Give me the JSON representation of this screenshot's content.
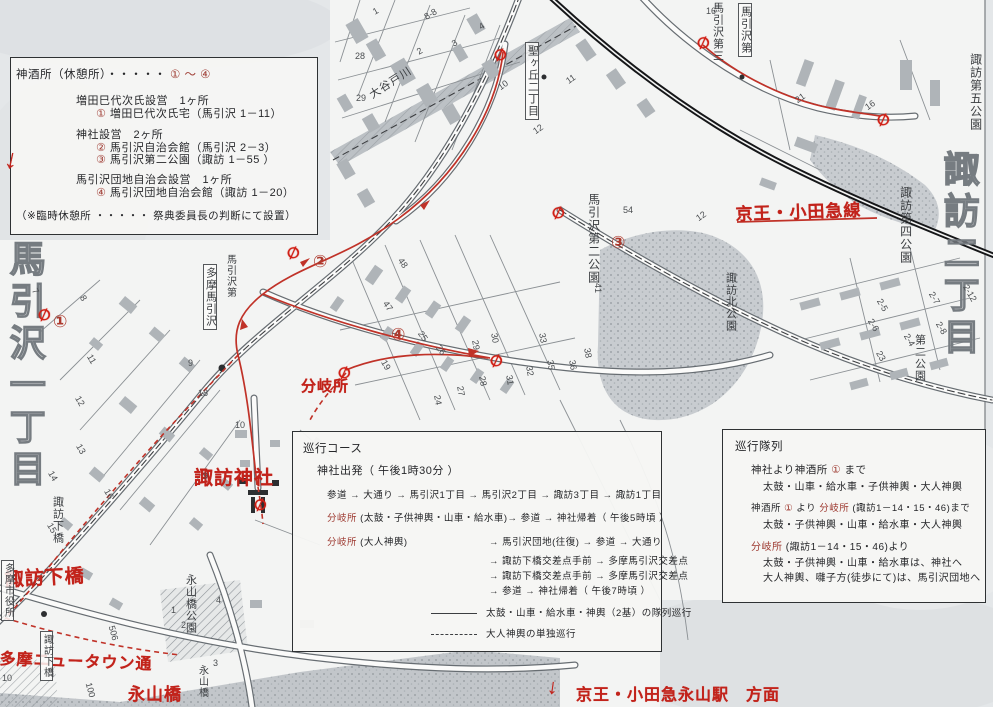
{
  "colors": {
    "paper": "#e6e8ea",
    "map_white": "#f3f4f3",
    "red_ink": "#c2231b",
    "box_red": "#9e3a31",
    "route_red": "#c03228",
    "railway_black": "#151618"
  },
  "boxes": {
    "rest": {
      "rows": [
        {
          "x": 5,
          "y": 8,
          "s": 11.5,
          "segs": [
            {
              "t": "神酒所（休憩所）・・・・・ "
            },
            {
              "t": "① ～ ④",
              "r": 1
            }
          ]
        },
        {
          "x": 65,
          "y": 34,
          "s": 11,
          "segs": [
            {
              "t": "増田巳代次氏設営　1ヶ所"
            }
          ]
        },
        {
          "x": 85,
          "y": 47,
          "s": 11,
          "segs": [
            {
              "t": "①",
              "r": 1
            },
            {
              "t": " 増田巳代次氏宅（馬引沢 1－11）"
            }
          ]
        },
        {
          "x": 65,
          "y": 68,
          "s": 11,
          "segs": [
            {
              "t": "神社設営　2ヶ所"
            }
          ]
        },
        {
          "x": 85,
          "y": 81,
          "s": 11,
          "segs": [
            {
              "t": "②",
              "r": 1
            },
            {
              "t": " 馬引沢自治会館（馬引沢 2－3）"
            }
          ]
        },
        {
          "x": 85,
          "y": 93,
          "s": 11,
          "segs": [
            {
              "t": "③",
              "r": 1
            },
            {
              "t": " 馬引沢第二公園（諏訪 1－55 ）"
            }
          ]
        },
        {
          "x": 65,
          "y": 113,
          "s": 11,
          "segs": [
            {
              "t": "馬引沢団地自治会設営　1ヶ所"
            }
          ]
        },
        {
          "x": 85,
          "y": 126,
          "s": 11,
          "segs": [
            {
              "t": "④",
              "r": 1
            },
            {
              "t": " 馬引沢団地自治会館（諏訪 1－20）"
            }
          ]
        },
        {
          "x": 5,
          "y": 150,
          "s": 10.5,
          "segs": [
            {
              "t": "（※臨時休憩所 ・・・・・ 祭典委員長の判断にて設置）"
            }
          ]
        }
      ]
    },
    "course": {
      "rows": [
        {
          "x": 10,
          "y": 8,
          "s": 11.5,
          "segs": [
            {
              "t": "巡行コース"
            }
          ]
        },
        {
          "x": 24,
          "y": 30,
          "s": 11,
          "segs": [
            {
              "t": "神社出発（ 午後1時30分 ）"
            }
          ]
        },
        {
          "x": 34,
          "y": 55,
          "s": 9.5,
          "segs": [
            {
              "t": "参道 → 大通り → 馬引沢1丁目 → 馬引沢2丁目 → 諏訪3丁目 → 諏訪1丁目"
            }
          ]
        },
        {
          "x": 34,
          "y": 78,
          "s": 9.5,
          "segs": [
            {
              "t": "分岐所",
              "r": 1
            },
            {
              "t": " (太鼓・子供神輿・山車・給水車)→ 参道 → 神社帰着（ 午後5時頃 ）"
            }
          ]
        },
        {
          "x": 34,
          "y": 102,
          "s": 9.5,
          "segs": [
            {
              "t": "分岐所",
              "r": 1
            },
            {
              "t": " (大人神輿)"
            }
          ]
        },
        {
          "x": 196,
          "y": 102,
          "s": 9.5,
          "segs": [
            {
              "t": "→ 馬引沢団地(往復) → 参道 → 大通り"
            }
          ]
        },
        {
          "x": 196,
          "y": 121,
          "s": 9.5,
          "segs": [
            {
              "t": "→ 諏訪下橋交差点手前 → 多摩馬引沢交差点"
            }
          ]
        },
        {
          "x": 196,
          "y": 136,
          "s": 9.5,
          "segs": [
            {
              "t": "→ 諏訪下橋交差点手前 → 多摩馬引沢交差点"
            }
          ]
        },
        {
          "x": 196,
          "y": 151,
          "s": 9.5,
          "segs": [
            {
              "t": "→ 参道 → 神社帰着（ 午後7時頃 ）"
            }
          ]
        },
        {
          "x": 138,
          "y": 173,
          "s": 9.5,
          "m": "solid",
          "segs": [
            {
              "t": "太鼓・山車・給水車・神輿（2基）の隊列巡行"
            }
          ]
        },
        {
          "x": 138,
          "y": 194,
          "s": 9.5,
          "m": "dashed",
          "segs": [
            {
              "t": "大人神輿の単独巡行"
            }
          ]
        }
      ]
    },
    "formation": {
      "rows": [
        {
          "x": 12,
          "y": 8,
          "s": 11.5,
          "segs": [
            {
              "t": "巡行隊列"
            }
          ]
        },
        {
          "x": 28,
          "y": 32,
          "s": 10.5,
          "segs": [
            {
              "t": "神社より神酒所 "
            },
            {
              "t": "①",
              "r": 1
            },
            {
              "t": " まで"
            }
          ]
        },
        {
          "x": 40,
          "y": 48,
          "s": 10,
          "segs": [
            {
              "t": "太鼓・山車・給水車・子供神輿・大人神輿"
            }
          ]
        },
        {
          "x": 28,
          "y": 70,
          "s": 9.5,
          "segs": [
            {
              "t": "神酒所 "
            },
            {
              "t": "①",
              "r": 1
            },
            {
              "t": " より "
            },
            {
              "t": "分岐所",
              "r": 1
            },
            {
              "t": " (諏訪1－14・15・46)まで"
            }
          ]
        },
        {
          "x": 40,
          "y": 86,
          "s": 10,
          "segs": [
            {
              "t": "太鼓・子供神輿・山車・給水車・大人神輿"
            }
          ]
        },
        {
          "x": 28,
          "y": 108,
          "s": 10,
          "segs": [
            {
              "t": "分岐所",
              "r": 1
            },
            {
              "t": " (諏訪1－14・15・46)より"
            }
          ]
        },
        {
          "x": 40,
          "y": 124,
          "s": 10,
          "segs": [
            {
              "t": "太鼓・子供神輿・山車・給水車は、神社へ"
            }
          ]
        },
        {
          "x": 40,
          "y": 139,
          "s": 10,
          "segs": [
            {
              "t": "大人神輿、囃子方(徒歩にて)は、馬引沢団地へ"
            }
          ]
        }
      ]
    }
  },
  "map": {
    "red_labels": [
      {
        "t": "京王・小田急線",
        "x": 735,
        "y": 200,
        "s": 17,
        "rot": -2
      },
      {
        "t": "分岐所",
        "x": 301,
        "y": 375,
        "s": 15,
        "rot": 0
      },
      {
        "t": "諏訪神社",
        "x": 194,
        "y": 463,
        "s": 19,
        "rot": 0
      },
      {
        "t": "諏訪下橋",
        "x": 4,
        "y": 565,
        "s": 19,
        "rot": -3
      },
      {
        "t": "多摩ニュータウン通",
        "x": 0,
        "y": 645,
        "s": 16,
        "rot": 2
      },
      {
        "t": "永山橋",
        "x": 128,
        "y": 680,
        "s": 17,
        "rot": 0
      },
      {
        "t": "↓",
        "x": 549,
        "y": 675,
        "s": 21,
        "rot": 8
      },
      {
        "t": "京王・小田急永山駅　方面",
        "x": 576,
        "y": 681,
        "s": 16,
        "rot": 0
      },
      {
        "t": "↓",
        "x": 8,
        "y": 143,
        "s": 27,
        "rot": 12
      }
    ],
    "black_labels": [
      {
        "t": "馬引沢一丁目",
        "x": 6,
        "y": 240,
        "s": 36,
        "outline": 1
      },
      {
        "t": "諏訪二丁目",
        "x": 940,
        "y": 150,
        "s": 36,
        "outline": 1
      },
      {
        "t": "諏訪第四公園",
        "x": 899,
        "y": 186,
        "s": 12
      },
      {
        "t": "諏訪第五公園",
        "x": 969,
        "y": 53,
        "s": 12
      },
      {
        "t": "第二公園",
        "x": 913,
        "y": 334,
        "s": 11
      },
      {
        "t": "諏訪北公園",
        "x": 724,
        "y": 272,
        "s": 11
      },
      {
        "t": "馬引沢第二公園",
        "x": 587,
        "y": 193,
        "s": 12
      },
      {
        "t": "馬引沢第三",
        "x": 711,
        "y": 2,
        "s": 11
      },
      {
        "t": "馬引沢第",
        "x": 738,
        "y": 3,
        "s": 11,
        "boxed": 1
      },
      {
        "t": "多摩馬引沢",
        "x": 203,
        "y": 264,
        "s": 11,
        "boxed": 1
      },
      {
        "t": "馬引沢第",
        "x": 224,
        "y": 254,
        "s": 10
      },
      {
        "t": "聖ヶ丘二丁目",
        "x": 525,
        "y": 42,
        "s": 11,
        "boxed": 1
      },
      {
        "t": "諏訪下橋",
        "x": 51,
        "y": 496,
        "s": 11
      },
      {
        "t": "諏訪下橋",
        "x": 40,
        "y": 631,
        "s": 10,
        "boxed": 1
      },
      {
        "t": "多摩市役所",
        "x": 1,
        "y": 560,
        "s": 10,
        "boxed": 1
      },
      {
        "t": "永山橋公園",
        "x": 184,
        "y": 574,
        "s": 11
      },
      {
        "t": "永山橋",
        "x": 196,
        "y": 665,
        "s": 10
      },
      {
        "t": "大谷戸川",
        "x": 368,
        "y": 92,
        "s": 11,
        "horiz": 1,
        "rot": -33
      }
    ],
    "circled_numbers": [
      {
        "n": "①",
        "x": 53,
        "y": 312,
        "s": 17
      },
      {
        "n": "②",
        "x": 313,
        "y": 252,
        "s": 17
      },
      {
        "n": "③",
        "x": 611,
        "y": 233,
        "s": 17
      },
      {
        "n": "④",
        "x": 391,
        "y": 325,
        "s": 17
      }
    ],
    "slash_markers": [
      [
        494,
        46
      ],
      [
        697,
        34
      ],
      [
        877,
        111
      ],
      [
        287,
        244
      ],
      [
        38,
        306
      ],
      [
        338,
        364
      ],
      [
        490,
        352
      ],
      [
        552,
        204
      ],
      [
        254,
        496
      ]
    ],
    "lot_numbers": [
      [
        706,
        6,
        "16",
        0
      ],
      [
        373,
        6,
        "1",
        -30
      ],
      [
        417,
        46,
        "2",
        -30
      ],
      [
        452,
        38,
        "3",
        -30
      ],
      [
        479,
        21,
        "4",
        -30
      ],
      [
        424,
        9,
        "8-8",
        -30
      ],
      [
        355,
        51,
        "28",
        0
      ],
      [
        356,
        93,
        "29",
        0
      ],
      [
        498,
        80,
        "10",
        -35
      ],
      [
        566,
        74,
        "11",
        -35
      ],
      [
        533,
        124,
        "12",
        -35
      ],
      [
        33,
        286,
        "7",
        60
      ],
      [
        81,
        293,
        "8",
        60
      ],
      [
        87,
        354,
        "11",
        60
      ],
      [
        75,
        396,
        "12",
        60
      ],
      [
        76,
        444,
        "13",
        60
      ],
      [
        48,
        471,
        "14",
        60
      ],
      [
        47,
        523,
        "15",
        60
      ],
      [
        104,
        489,
        "16",
        60
      ],
      [
        383,
        301,
        "47",
        55
      ],
      [
        398,
        258,
        "48",
        55
      ],
      [
        418,
        331,
        "25",
        55
      ],
      [
        436,
        345,
        "26",
        55
      ],
      [
        433,
        395,
        "24",
        80
      ],
      [
        456,
        386,
        "27",
        80
      ],
      [
        478,
        376,
        "28",
        80
      ],
      [
        471,
        340,
        "29",
        80
      ],
      [
        490,
        333,
        "30",
        80
      ],
      [
        505,
        375,
        "31",
        80
      ],
      [
        525,
        366,
        "32",
        80
      ],
      [
        538,
        333,
        "33",
        80
      ],
      [
        546,
        360,
        "35",
        80
      ],
      [
        568,
        360,
        "36",
        80
      ],
      [
        583,
        348,
        "38",
        80
      ],
      [
        623,
        205,
        "54",
        0
      ],
      [
        696,
        211,
        "12",
        -35
      ],
      [
        593,
        283,
        "41",
        90
      ],
      [
        795,
        93,
        "21",
        -35
      ],
      [
        865,
        100,
        "16",
        -35
      ],
      [
        876,
        300,
        "2-5",
        60
      ],
      [
        867,
        320,
        "2-6",
        60
      ],
      [
        903,
        335,
        "2-4",
        60
      ],
      [
        928,
        293,
        "2-7",
        60
      ],
      [
        935,
        323,
        "2-8",
        60
      ],
      [
        961,
        288,
        "2-12",
        60
      ],
      [
        876,
        351,
        "23",
        60
      ],
      [
        188,
        358,
        "9",
        0
      ],
      [
        198,
        388,
        "18",
        0
      ],
      [
        235,
        420,
        "10",
        0
      ],
      [
        381,
        360,
        "19",
        60
      ],
      [
        203,
        471,
        "9",
        0
      ],
      [
        106,
        628,
        "506",
        75
      ],
      [
        83,
        685,
        "100",
        75
      ],
      [
        2,
        673,
        "10",
        0
      ],
      [
        216,
        595,
        "4",
        0
      ],
      [
        213,
        658,
        "3",
        0
      ],
      [
        181,
        620,
        "2",
        0
      ],
      [
        171,
        605,
        "1",
        0
      ]
    ]
  }
}
